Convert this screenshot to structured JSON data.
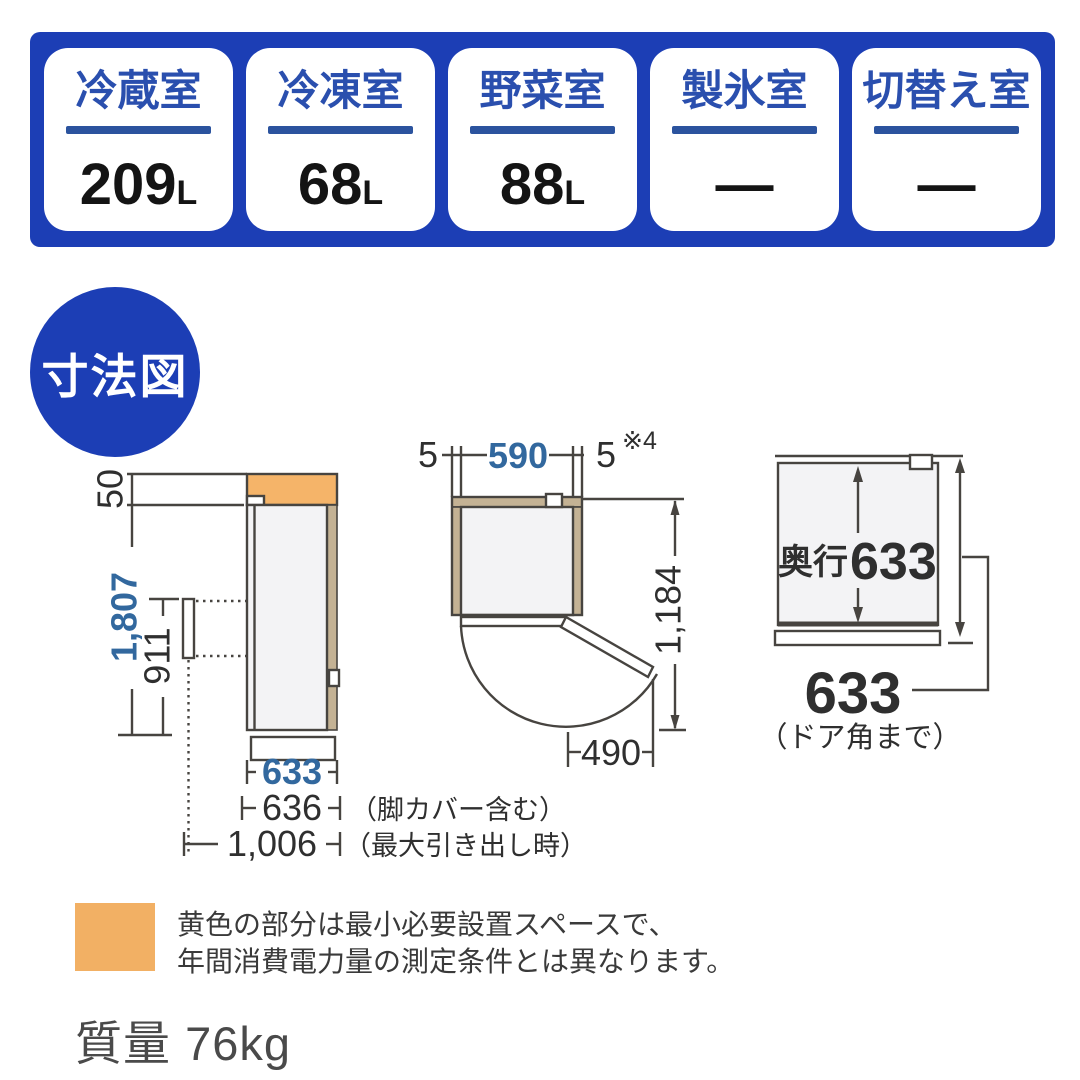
{
  "capacity_banner": {
    "cards": [
      {
        "label": "冷蔵室",
        "value": "209",
        "unit": "L"
      },
      {
        "label": "冷凍室",
        "value": "68",
        "unit": "L"
      },
      {
        "label": "野菜室",
        "value": "88",
        "unit": "L"
      },
      {
        "label": "製氷室",
        "value": "—",
        "unit": ""
      },
      {
        "label": "切替え室",
        "value": "—",
        "unit": ""
      }
    ]
  },
  "badge": {
    "label": "寸法図"
  },
  "side_view": {
    "dim_top_clearance": "50",
    "dim_total_height": "1,807",
    "dim_drawer_height": "911",
    "dim_depth": "633",
    "dim_depth_with_cover": "636",
    "dim_depth_drawer_open": "1,006",
    "note_with_cover": "（脚カバー含む）",
    "note_drawer_open": "（最大引き出し時）"
  },
  "top_view": {
    "dim_left_gap": "5",
    "dim_width": "590",
    "dim_right_gap": "5",
    "footnote": "※4",
    "dim_door_open_depth": "1,184",
    "dim_door_swing": "490"
  },
  "depth_view": {
    "depth_label": "奥行",
    "depth_value": "633",
    "dim_to_door_corner": "633",
    "note_to_door_corner": "（ドア角まで）"
  },
  "legend": {
    "line1": "黄色の部分は最小必要設置スペースで、",
    "line2": "年間消費電力量の測定条件とは異なります。"
  },
  "weight": {
    "label": "質量",
    "value": "76kg"
  },
  "colors": {
    "banner_blue": "#1c3eb5",
    "dim_blue": "#32689e",
    "space_orange": "#f2b064",
    "space_tan": "#c4b294",
    "line": "#474440"
  }
}
